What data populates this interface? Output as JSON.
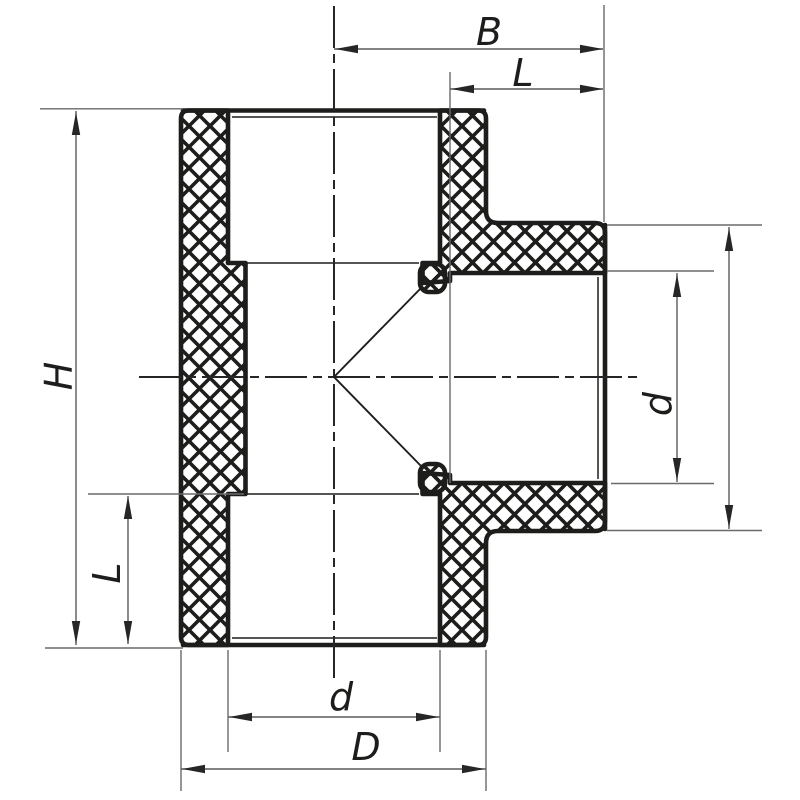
{
  "figure": {
    "kind": "cross-section technical drawing of a tee pipe fitting",
    "background": "#ffffff",
    "colors": {
      "ink": "#1d1d1b",
      "thin_line": "#5a5a5a",
      "arrow": "#262626"
    }
  },
  "dims": {
    "B": "B",
    "L_top": "L",
    "H": "H",
    "L_left": "L",
    "d_bottom": "d",
    "D_bottom": "D",
    "d_right": "d"
  }
}
